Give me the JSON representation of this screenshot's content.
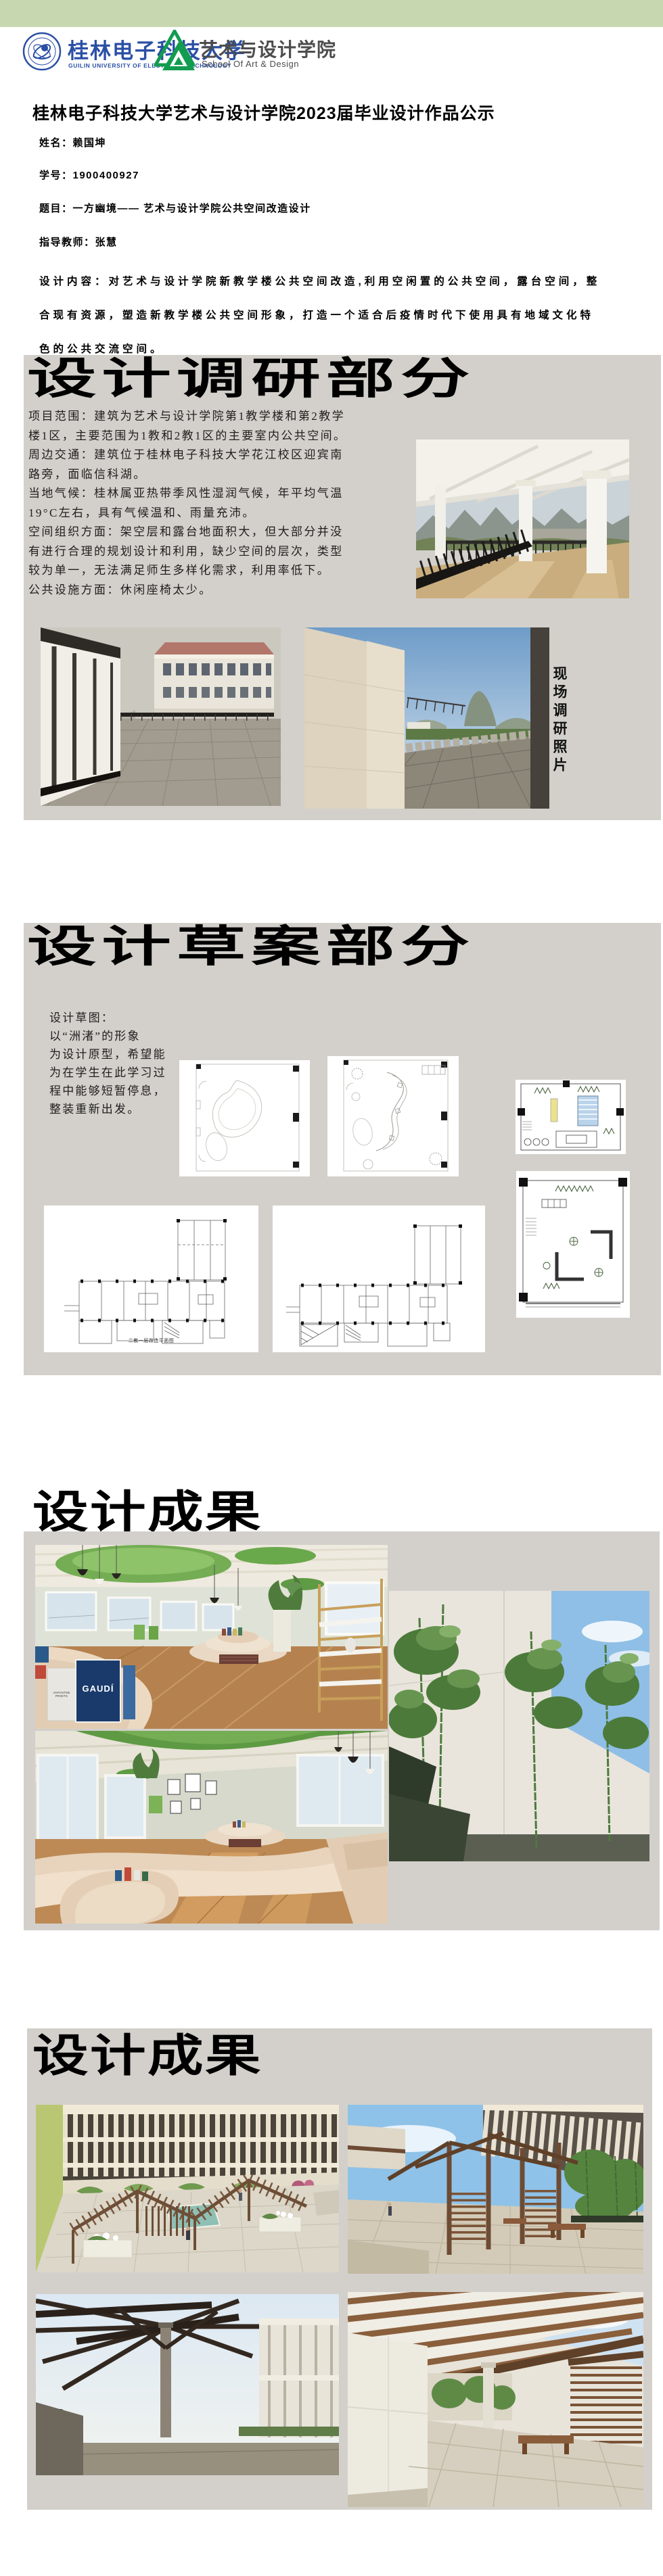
{
  "colors": {
    "top_bar_green": "#c7d8b1",
    "section_gray": "#d3d0cb",
    "logo_blue": "#2a4fa5",
    "logo_green": "#129c4f"
  },
  "header": {
    "university": {
      "name_cn": "桂林电子科技大学",
      "name_en": "GUILIN UNIVERSITY OF ELECTRONIC TECHNOLOGY"
    },
    "school": {
      "name_cn": "艺术与设计学院",
      "name_en": "School Of Art & Design"
    }
  },
  "title": "桂林电子科技大学艺术与设计学院2023届毕业设计作品公示",
  "info": {
    "name": "姓名：赖国坤",
    "student_id": "学号：1900400927",
    "topic": "题目：一方幽境—— 艺术与设计学院公共空间改造设计",
    "advisor": "指导教师：张慧",
    "description": "设计内容：对艺术与设计学院新教学楼公共空间改造,利用空闲置的公共空间，露台空间，整\n合现有资源，塑造新教学楼公共空间形象，打造一个适合后疫情时代下使用具有地域文化特\n色的公共交流空间。"
  },
  "research": {
    "heading": "设计调研部分",
    "body": "项目范围：建筑为艺术与设计学院第1教学楼和第2教学\n楼1区，主要范围为1教和2教1区的主要室内公共空间。\n周边交通：建筑位于桂林电子科技大学花江校区迎宾南\n路旁，面临信科湖。\n当地气候：桂林属亚热带季风性湿润气候，年平均气温\n19°C左右，具有气候温和、雨量充沛。\n空间组织方面：架空层和露台地面积大，但大部分并没\n有进行合理的规划设计和利用，缺少空间的层次，类型\n较为单一，无法满足师生多样化需求，利用率低下。\n公共设施方面：休闲座椅太少。",
    "photos_label": "现场调研照片"
  },
  "draft": {
    "heading": "设计草案部分",
    "body": "设计草图：\n 以“洲渚”的形象\n为设计原型，希望能\n为在学生在此学习过\n程中能够短暂停息，\n整装重新出发。",
    "plan_caption": "二教一层改造平面图"
  },
  "results1": {
    "heading": "设计成果",
    "book_label_large": "GAUDÍ",
    "book_label_small": "JAPANTSE PRINTS"
  },
  "results2": {
    "heading": "设计成果"
  }
}
